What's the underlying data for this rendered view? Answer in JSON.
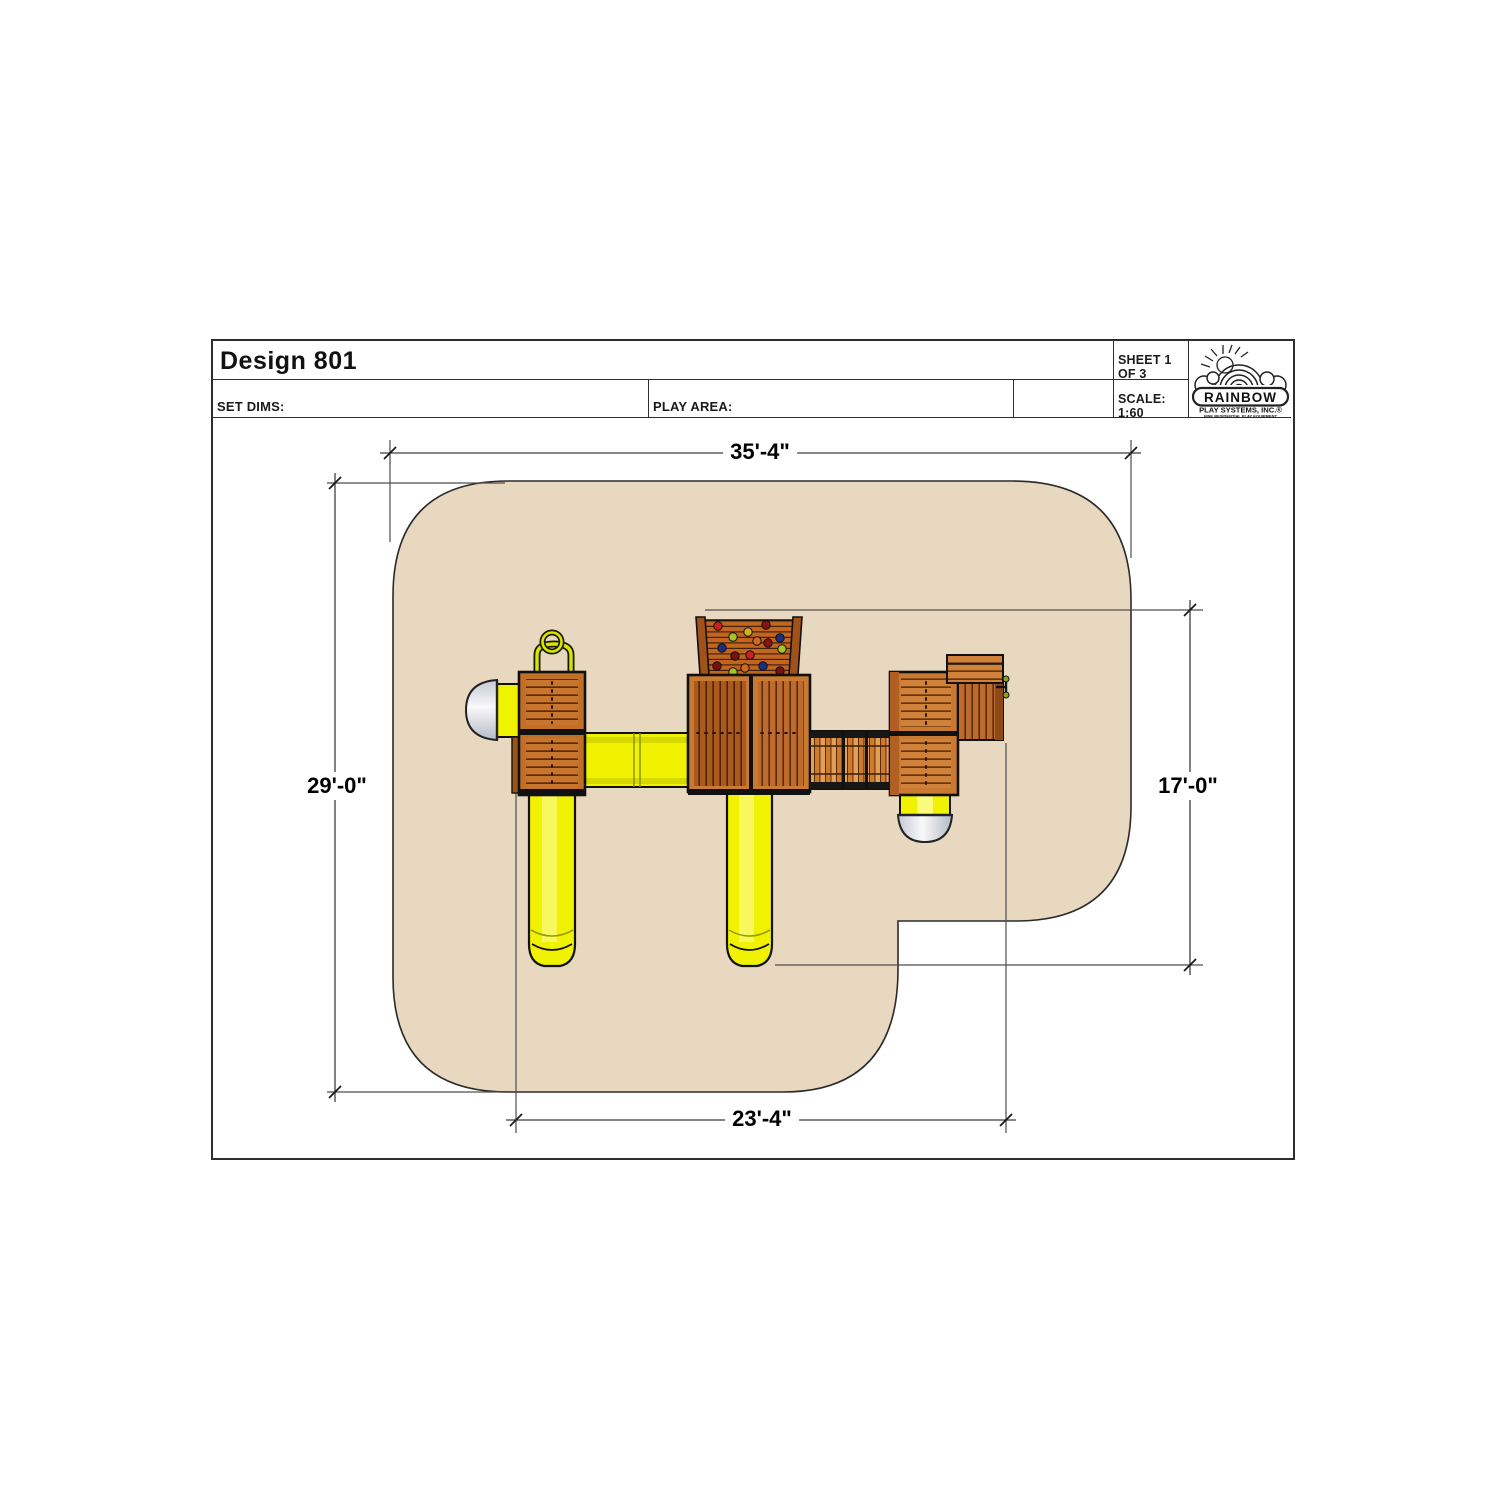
{
  "title_block": {
    "design_title": "Design 801",
    "set_dims_label": "SET DIMS:",
    "play_area_label": "PLAY AREA:",
    "sheet_label": "SHEET 1 OF 3",
    "scale_label": "SCALE: 1:60"
  },
  "logo": {
    "name": "RAINBOW",
    "subtitle": "PLAY SYSTEMS, INC.®",
    "tagline": "FINE RESIDENTIAL PLAY EQUIPMENT"
  },
  "dimensions": {
    "top_width": "35'-4\"",
    "left_height": "29'-0\"",
    "right_height": "17'-0\"",
    "bottom_width": "23'-4\""
  },
  "colors": {
    "play_area_fill": "#e8d8bf",
    "slide_yellow": "#f0f200",
    "wood_frame": "#c8762e",
    "wood_dark": "#a6571c",
    "outline": "#111111",
    "dim_line": "#4d4d4d"
  }
}
